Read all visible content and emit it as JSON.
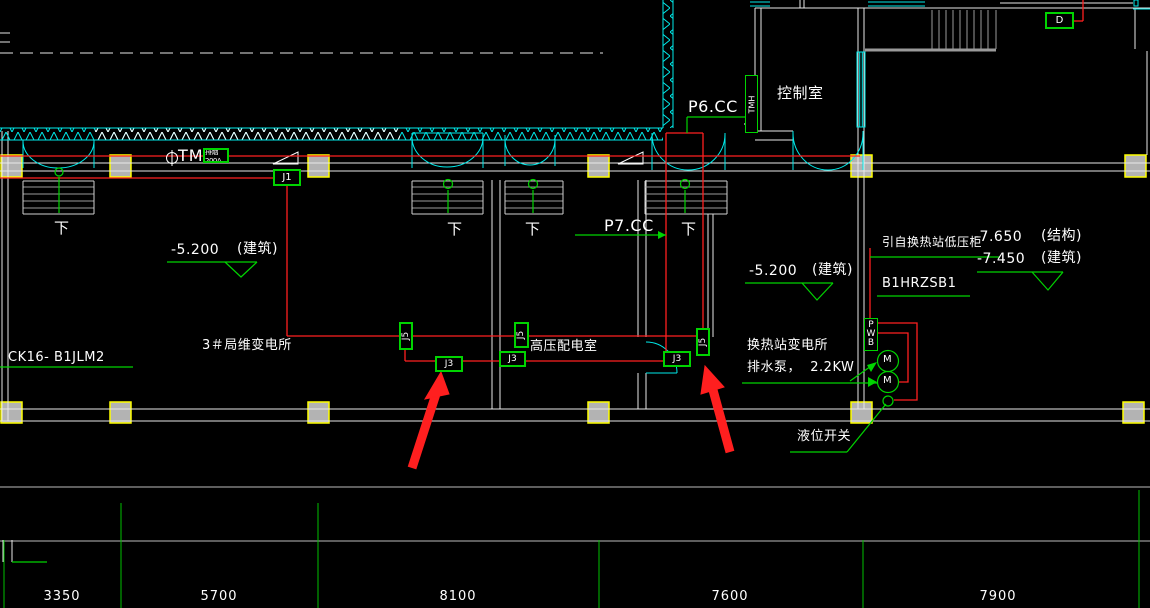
{
  "rooms": {
    "control": "控制室",
    "hv": "高压配电室",
    "sub3": "3＃局维变电所",
    "hx_line1": "换热站变电所",
    "hx_line2": "排水泵，  2.2KW"
  },
  "circuits": {
    "p6": "P6.CC",
    "p7": "P7.CC",
    "feeder": "引自换热站低压柜",
    "panel": "B1HRZSB1",
    "cable": "CK16- B1JLM2"
  },
  "devices": {
    "d_box": "D",
    "j1": "J1",
    "j3": "J3",
    "j5": "J5",
    "pwb": "PWB",
    "motor": "M",
    "tmh": "TMH",
    "tmh_tag": "排烟200A",
    "level_switch": "液位开关"
  },
  "stairs": {
    "down": "下"
  },
  "elevations": {
    "left_val": "-5.200",
    "left_kind": "(建筑)",
    "mid_val": "-5.200",
    "mid_kind": "(建筑)",
    "r1_val": "-7.650",
    "r1_kind": "(结构)",
    "r2_val": "-7.450",
    "r2_kind": "(建筑)"
  },
  "dimensions": {
    "values": [
      "3350",
      "5700",
      "8100",
      "7600",
      "7900"
    ]
  },
  "colors": {
    "background": "#000000",
    "wall": "#ffffff",
    "wire": "#ff2020",
    "annotation": "#00d400",
    "detail": "#00eaea",
    "column_fill": "#b3b3b3",
    "column_border": "#ffff00",
    "stair": "#9a9a9a"
  }
}
